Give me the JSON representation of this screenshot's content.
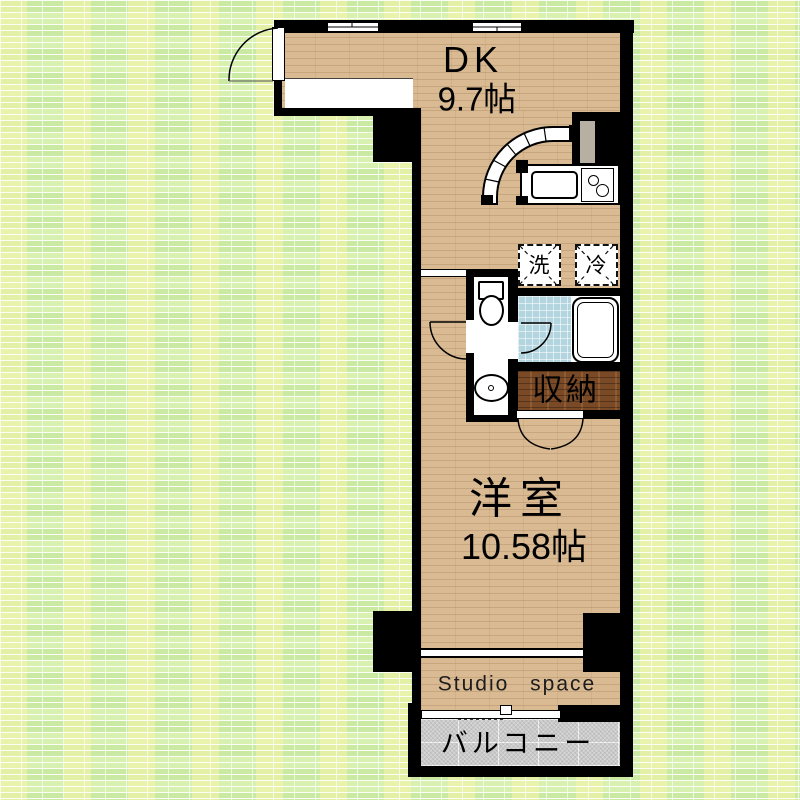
{
  "plan": {
    "rooms": {
      "dk": {
        "name": "DK",
        "size": "9.7帖"
      },
      "western": {
        "name": "洋室",
        "size": "10.58帖"
      },
      "storage": {
        "name": "収納"
      },
      "balcony": {
        "name": "バルコニー"
      },
      "studio": {
        "name": "Studio space"
      }
    },
    "appliances": {
      "washer": {
        "label": "洗"
      },
      "fridge": {
        "label": "冷"
      }
    },
    "colors": {
      "wall": "#000000",
      "wood_floor": "#d9ba93",
      "storage_wood": "#7a4a27",
      "bath_tile": "#b2d5e0",
      "balcony_floor": "#cacaca",
      "background": "#d8f0b0"
    }
  }
}
